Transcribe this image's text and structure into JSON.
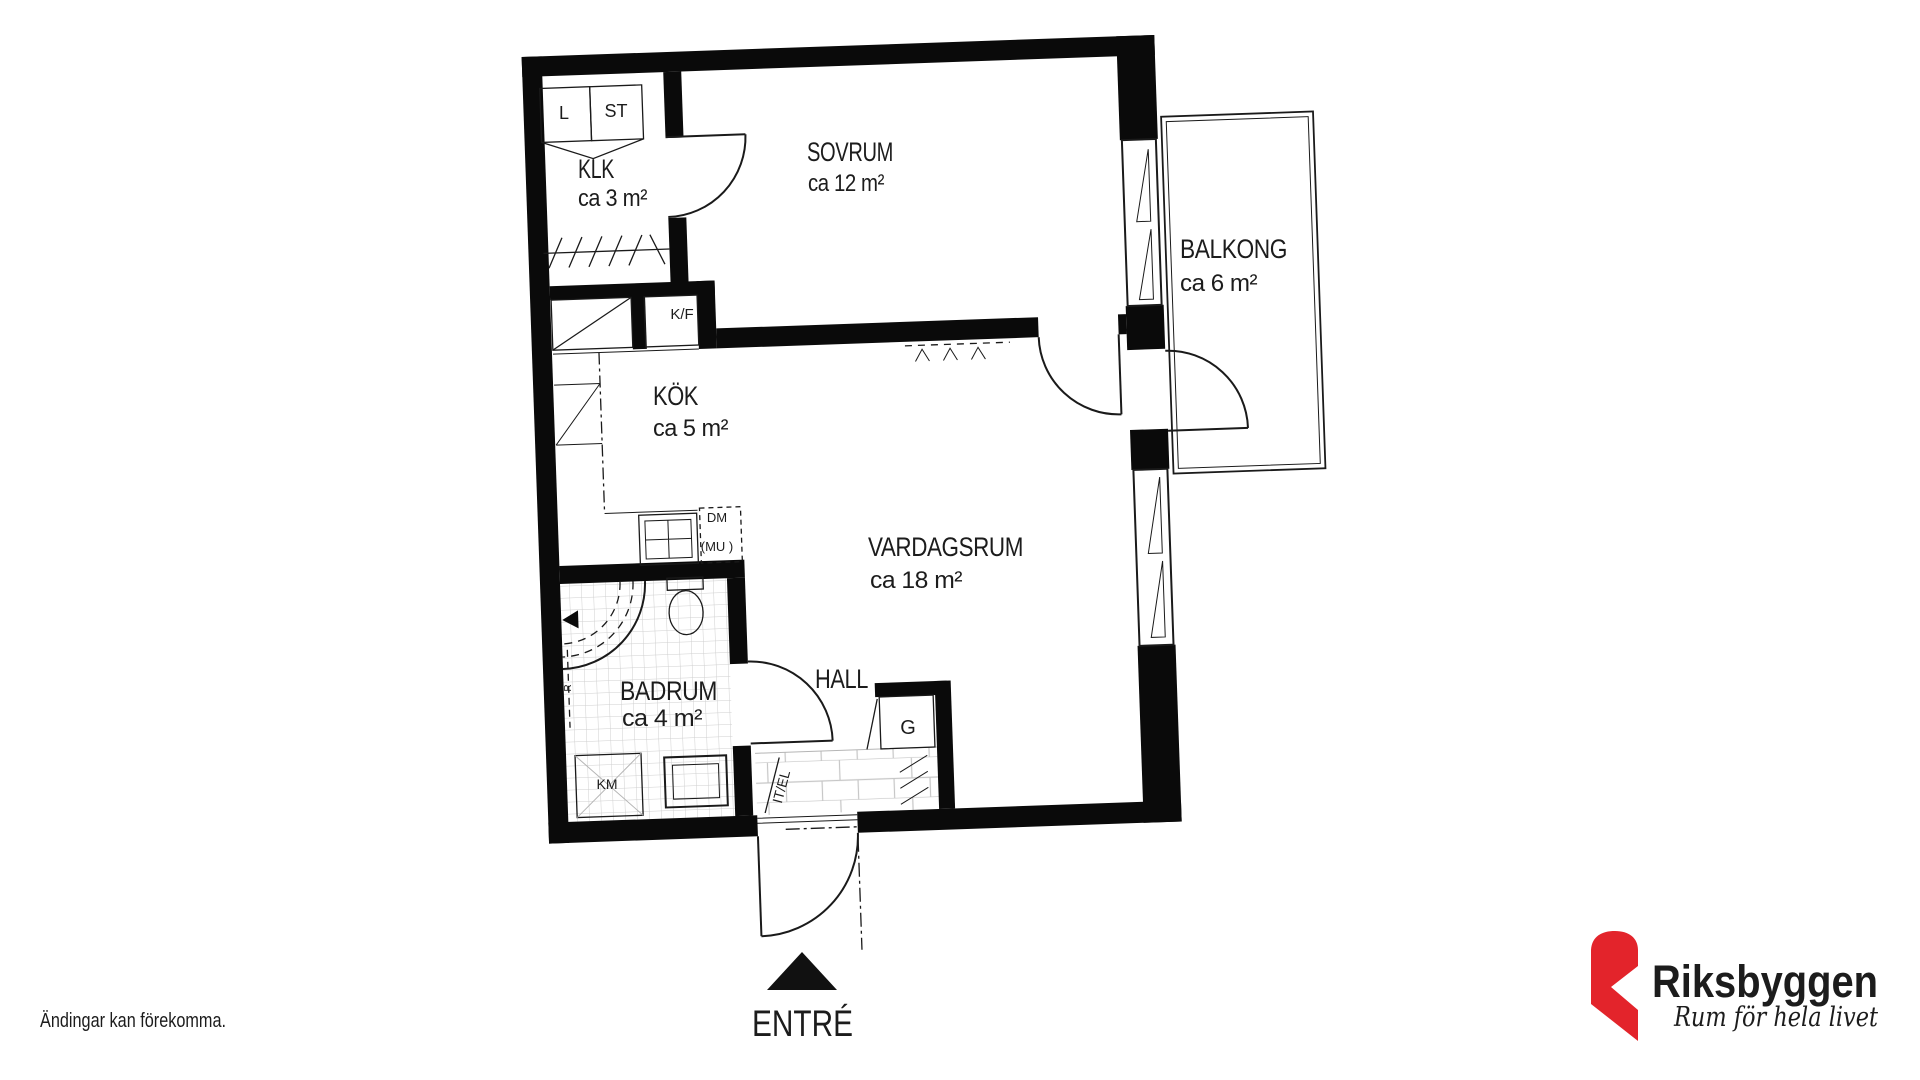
{
  "plan": {
    "rooms": [
      {
        "id": "klk",
        "name": "KLK",
        "area": "ca 3 m²"
      },
      {
        "id": "sovrum",
        "name": "SOVRUM",
        "area": "ca 12 m²"
      },
      {
        "id": "kok",
        "name": "KÖK",
        "area": "ca 5 m²"
      },
      {
        "id": "vardagsrum",
        "name": "VARDAGSRUM",
        "area": "ca 18 m²"
      },
      {
        "id": "badrum",
        "name": "BADRUM",
        "area": "ca 4 m²"
      },
      {
        "id": "balkong",
        "name": "BALKONG",
        "area": "ca 6 m²"
      },
      {
        "id": "hall",
        "name": "HALL",
        "area": ""
      }
    ],
    "fixture_labels": {
      "l": "L",
      "st": "ST",
      "kf": "K/F",
      "dm": "DM",
      "mu": "(MU )",
      "km": "KM",
      "g": "G",
      "itel": "IT/EL",
      "r": "R"
    },
    "entrance_label": "ENTRÉ"
  },
  "footer": {
    "disclaimer": "Ändingar kan förekomma."
  },
  "logo": {
    "brand": "Riksbyggen",
    "tagline": "Rum för hela livet",
    "accent_red": "#e3242b",
    "brand_gray": "#8c8f91",
    "tagline_color": "#1b1b1b"
  }
}
